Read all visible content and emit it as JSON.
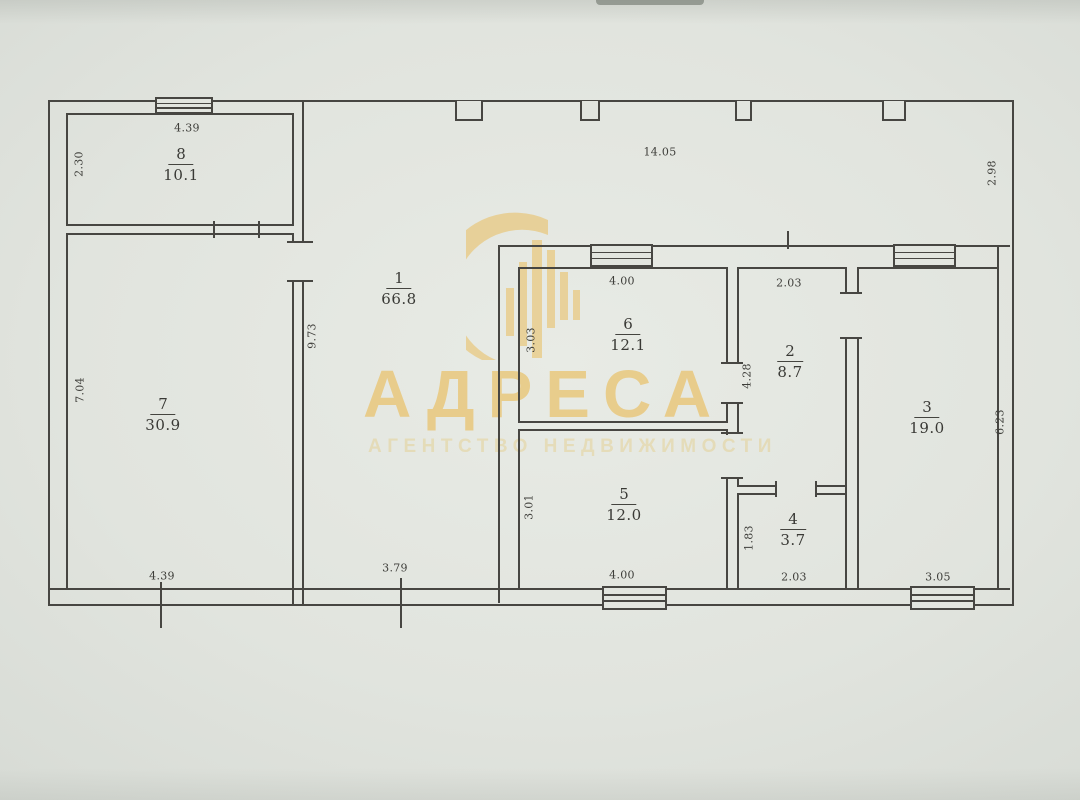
{
  "watermark": {
    "title": "АДРЕСА",
    "subtitle": "АГЕНТСТВО НЕДВИЖИМОСТИ",
    "logo": "building-arch-icon",
    "color": "#eaba52"
  },
  "floor_plan": {
    "rooms": {
      "r1": {
        "number": "1",
        "area": "66.8"
      },
      "r2": {
        "number": "2",
        "area": "8.7"
      },
      "r3": {
        "number": "3",
        "area": "19.0"
      },
      "r4": {
        "number": "4",
        "area": "3.7"
      },
      "r5": {
        "number": "5",
        "area": "12.0"
      },
      "r6": {
        "number": "6",
        "area": "12.1"
      },
      "r7": {
        "number": "7",
        "area": "30.9"
      },
      "r8": {
        "number": "8",
        "area": "10.1"
      }
    },
    "dimensions": {
      "room8_width": "4.39",
      "room8_height": "2.30",
      "room1_width": "14.05",
      "room1_right_height": "2.98",
      "room1_left_height": "9.73",
      "room1_bottom_width": "3.79",
      "room7_height": "7.04",
      "room7_width": "4.39",
      "room6_width": "4.00",
      "room6_height": "3.03",
      "room5_height": "3.01",
      "room5_width": "4.00",
      "room2_width": "2.03",
      "room2_height": "4.28",
      "room4_height": "1.83",
      "room4_width": "2.03",
      "room3_height": "6.23",
      "room3_width": "3.05"
    }
  }
}
